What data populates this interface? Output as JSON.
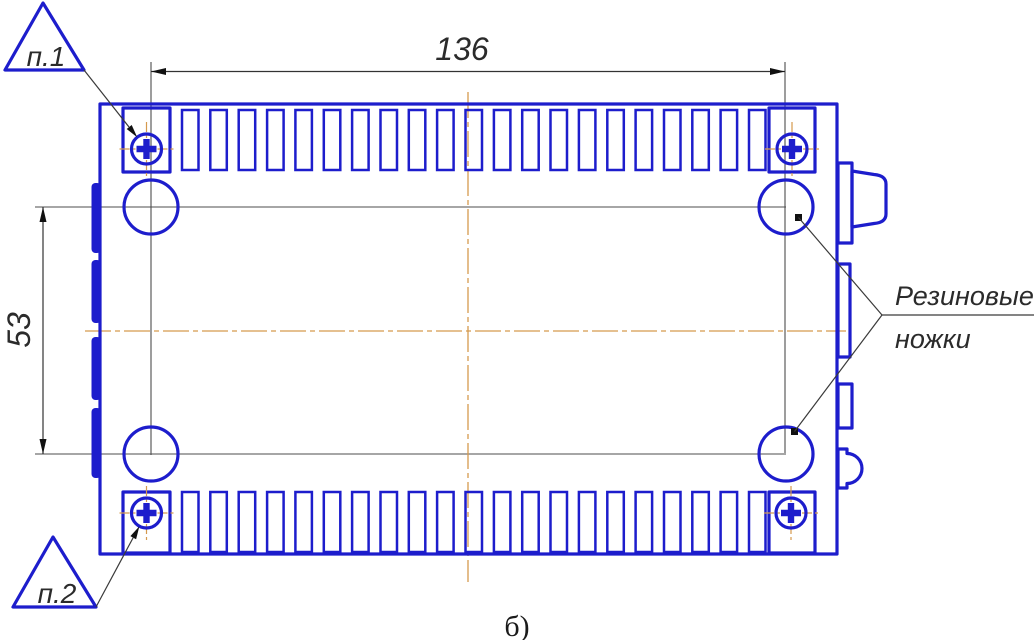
{
  "drawing": {
    "kind": "engineering-drawing-bottom-view",
    "caption": "б)",
    "dimensions": {
      "width": {
        "value": "136",
        "orientation": "horizontal"
      },
      "height": {
        "value": "53",
        "orientation": "vertical"
      }
    },
    "callouts": {
      "p1": {
        "label": "п.1"
      },
      "p2": {
        "label": "п.2"
      }
    },
    "note": {
      "line1": "Резиновые",
      "line2": "ножки"
    },
    "vents": {
      "top_count": 21,
      "bottom_count": 21
    },
    "feet_count": 4,
    "screws_count": 4,
    "colors": {
      "outline": "#1d1dcc",
      "centerline": "#d59a4e",
      "construction": "#4d4d4d",
      "text": "#2b2b2b"
    }
  }
}
